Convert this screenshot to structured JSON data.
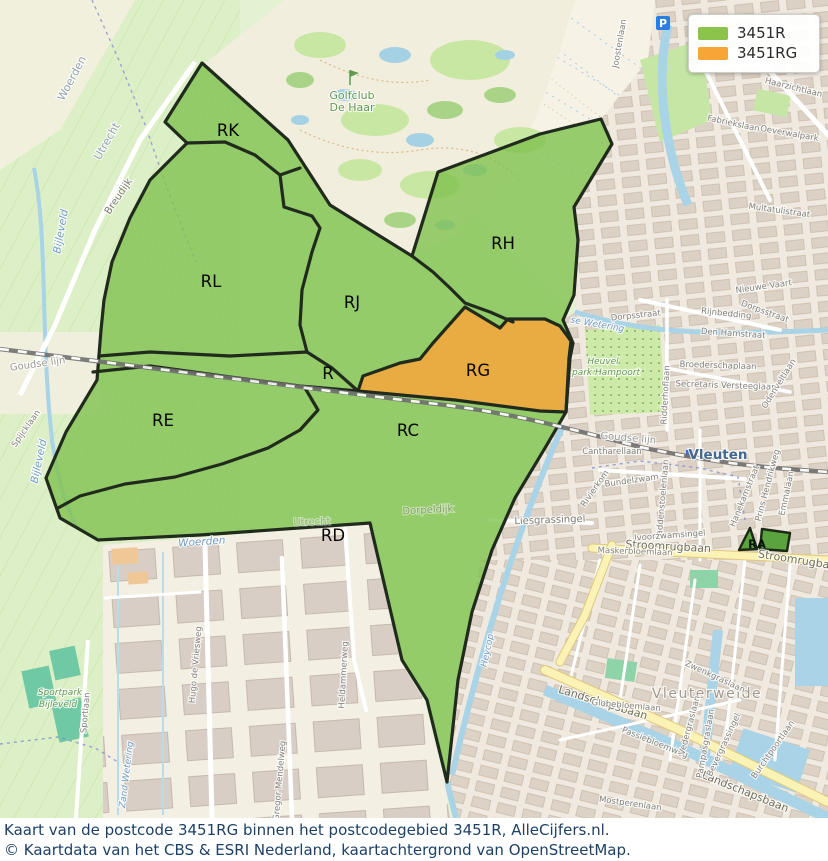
{
  "legend": {
    "items": [
      {
        "label": "3451R",
        "color": "#8bc34b"
      },
      {
        "label": "3451RG",
        "color": "#f6a637"
      }
    ]
  },
  "caption": {
    "line1": "Kaart van de postcode 3451RG binnen het postcodegebied 3451R, AlleCijfers.nl.",
    "line2": "© Kaartdata van het CBS & ESRI Nederland, kaartachtergrond van OpenStreetMap."
  },
  "map": {
    "colors": {
      "region_fill": "#7fc24f",
      "rg_fill": "#efa93f",
      "border": "#212b1d",
      "railway": "#707070",
      "water": "#a9d3e6",
      "urban": "#efe9df",
      "golf": "#f2eedd"
    },
    "region_labels": [
      {
        "label": "RK",
        "x": 228,
        "y": 136
      },
      {
        "label": "RL",
        "x": 211,
        "y": 287
      },
      {
        "label": "RJ",
        "x": 352,
        "y": 308
      },
      {
        "label": "RH",
        "x": 503,
        "y": 249
      },
      {
        "label": "R",
        "x": 328,
        "y": 379
      },
      {
        "label": "RG",
        "x": 478,
        "y": 376
      },
      {
        "label": "RE",
        "x": 163,
        "y": 426
      },
      {
        "label": "RC",
        "x": 408,
        "y": 436
      },
      {
        "label": "RD",
        "x": 333,
        "y": 541
      },
      {
        "label": "RA",
        "x": 757,
        "y": 548,
        "small": true
      }
    ],
    "labels": [
      {
        "text": "Woerden",
        "x": 75,
        "y": 80,
        "rot": -62,
        "cls": "muni"
      },
      {
        "text": "Utrecht",
        "x": 110,
        "y": 143,
        "rot": -60,
        "cls": "muni"
      },
      {
        "text": "Breudijk",
        "x": 121,
        "y": 198,
        "rot": -56,
        "cls": "street"
      },
      {
        "text": "Golfclub",
        "x": 352,
        "y": 99,
        "rot": 0,
        "cls": "green"
      },
      {
        "text": "De Haar",
        "x": 352,
        "y": 111,
        "rot": 0,
        "cls": "green"
      },
      {
        "text": "Bijleveld",
        "x": 64,
        "y": 232,
        "rot": -80,
        "cls": "blue"
      },
      {
        "text": "Goudse lijn",
        "x": 38,
        "y": 367,
        "rot": -8,
        "cls": "gray"
      },
      {
        "text": "Goudse lijn",
        "x": 628,
        "y": 441,
        "rot": 5,
        "cls": "gray"
      },
      {
        "text": "Spijcklaan",
        "x": 28,
        "y": 430,
        "rot": -55,
        "cls": "streetS"
      },
      {
        "text": "Bijleveld",
        "x": 42,
        "y": 462,
        "rot": -78,
        "cls": "blue"
      },
      {
        "text": "Vleuten",
        "x": 718,
        "y": 459,
        "rot": 0,
        "cls": "town"
      },
      {
        "text": "Cantharellaan",
        "x": 612,
        "y": 454,
        "rot": 0,
        "cls": "streetS"
      },
      {
        "text": "Rivierkom",
        "x": 597,
        "y": 490,
        "rot": -55,
        "cls": "streetS"
      },
      {
        "text": "Bundelzwam",
        "x": 632,
        "y": 483,
        "rot": -8,
        "cls": "streetS"
      },
      {
        "text": "Paddenstoelenlaan",
        "x": 665,
        "y": 500,
        "rot": -85,
        "cls": "streetS"
      },
      {
        "text": "Hanekamstraat",
        "x": 747,
        "y": 497,
        "rot": -68,
        "cls": "streetS"
      },
      {
        "text": "Prins Hendrikweg",
        "x": 770,
        "y": 486,
        "rot": -75,
        "cls": "streetS"
      },
      {
        "text": "Emmalaan",
        "x": 789,
        "y": 494,
        "rot": -78,
        "cls": "streetS"
      },
      {
        "text": "Liesgrassingel",
        "x": 550,
        "y": 523,
        "rot": -2,
        "cls": "street"
      },
      {
        "text": "Ivoorzwamsingel",
        "x": 670,
        "y": 538,
        "rot": -4,
        "cls": "streetS"
      },
      {
        "text": "Stroomrugbaan",
        "x": 668,
        "y": 550,
        "rot": 3,
        "cls": "road"
      },
      {
        "text": "Stroomrugbaan",
        "x": 800,
        "y": 564,
        "rot": 9,
        "cls": "road"
      },
      {
        "text": "Maskerbloemlaan",
        "x": 635,
        "y": 554,
        "rot": 2,
        "cls": "streetS"
      },
      {
        "text": "Dorpsstraat",
        "x": 636,
        "y": 318,
        "rot": -6,
        "cls": "streetS"
      },
      {
        "text": "Dorpsstraat",
        "x": 764,
        "y": 314,
        "rot": 20,
        "cls": "streetS"
      },
      {
        "text": "Rijnbedding",
        "x": 726,
        "y": 316,
        "rot": 6,
        "cls": "streetS"
      },
      {
        "text": "Den Hamstraat",
        "x": 733,
        "y": 336,
        "rot": 4,
        "cls": "streetS"
      },
      {
        "text": "Broederschaplaan",
        "x": 718,
        "y": 368,
        "rot": 2,
        "cls": "streetS"
      },
      {
        "text": "Secretaris Versteeglaan",
        "x": 726,
        "y": 388,
        "rot": 2,
        "cls": "streetS"
      },
      {
        "text": "Ridderhoflaan",
        "x": 668,
        "y": 395,
        "rot": -87,
        "cls": "streetS"
      },
      {
        "text": "Odenveltlaan",
        "x": 781,
        "y": 385,
        "rot": -58,
        "cls": "streetS"
      },
      {
        "text": "Nieuwe Vaart",
        "x": 764,
        "y": 289,
        "rot": -8,
        "cls": "streetS"
      },
      {
        "text": "Haarzichtlaan",
        "x": 793,
        "y": 90,
        "rot": 14,
        "cls": "streetS"
      },
      {
        "text": "Oeverwalpark",
        "x": 789,
        "y": 136,
        "rot": 10,
        "cls": "streetS"
      },
      {
        "text": "Multatulistraat",
        "x": 779,
        "y": 213,
        "rot": 8,
        "cls": "streetS"
      },
      {
        "text": "Fabriekslaan",
        "x": 733,
        "y": 126,
        "rot": 12,
        "cls": "streetS"
      },
      {
        "text": "Joostenlaan",
        "x": 622,
        "y": 44,
        "rot": -80,
        "cls": "streetS"
      },
      {
        "text": "Heuvel",
        "x": 603,
        "y": 364,
        "rot": 0,
        "cls": "greenS"
      },
      {
        "text": "park Hampoort",
        "x": 606,
        "y": 375,
        "rot": 0,
        "cls": "greenS"
      },
      {
        "text": "se Wetering",
        "x": 597,
        "y": 327,
        "rot": 10,
        "cls": "blueS"
      },
      {
        "text": "Heycop",
        "x": 490,
        "y": 651,
        "rot": -78,
        "cls": "blueS"
      },
      {
        "text": "Vleuterweide",
        "x": 707,
        "y": 698,
        "rot": 0,
        "cls": "district"
      },
      {
        "text": "Landschapsbaan",
        "x": 602,
        "y": 706,
        "rot": 17,
        "cls": "road"
      },
      {
        "text": "Landschapsbaan",
        "x": 744,
        "y": 795,
        "rot": 22,
        "cls": "road"
      },
      {
        "text": "Globebloemlaan",
        "x": 626,
        "y": 708,
        "rot": 5,
        "cls": "streetS"
      },
      {
        "text": "Passiebloemweg",
        "x": 654,
        "y": 745,
        "rot": 22,
        "cls": "streetS"
      },
      {
        "text": "Mostperenlaan",
        "x": 630,
        "y": 806,
        "rot": 8,
        "cls": "streetS"
      },
      {
        "text": "Vedergraslaan",
        "x": 692,
        "y": 726,
        "rot": -75,
        "cls": "streetS"
      },
      {
        "text": "Zwenkgraslaan",
        "x": 714,
        "y": 679,
        "rot": 25,
        "cls": "streetS"
      },
      {
        "text": "Pampasgraslaan",
        "x": 708,
        "y": 744,
        "rot": -80,
        "cls": "streetS"
      },
      {
        "text": "Bevergrassingel",
        "x": 726,
        "y": 746,
        "rot": -65,
        "cls": "streetS"
      },
      {
        "text": "Burchtpoortlaan",
        "x": 775,
        "y": 751,
        "rot": -55,
        "cls": "streetS"
      },
      {
        "text": "Dorpeldijk",
        "x": 428,
        "y": 513,
        "rot": -3,
        "cls": "street",
        "dim": true
      },
      {
        "text": "Utrecht",
        "x": 312,
        "y": 525,
        "rot": -2,
        "cls": "gray",
        "dim": true
      },
      {
        "text": "Woerden",
        "x": 202,
        "y": 545,
        "rot": -4,
        "cls": "blue"
      },
      {
        "text": "Hugo de Vriesweg",
        "x": 198,
        "y": 665,
        "rot": -85,
        "cls": "streetS"
      },
      {
        "text": "Gregor Mendelweg",
        "x": 282,
        "y": 781,
        "rot": -85,
        "cls": "streetS"
      },
      {
        "text": "Heldammerweg",
        "x": 346,
        "y": 675,
        "rot": -87,
        "cls": "streetS"
      },
      {
        "text": "Zand Wetering",
        "x": 129,
        "y": 775,
        "rot": -83,
        "cls": "blueS"
      },
      {
        "text": "Sportpark",
        "x": 60,
        "y": 695,
        "rot": 0,
        "cls": "greenS"
      },
      {
        "text": "Bijleveld",
        "x": 58,
        "y": 707,
        "rot": 0,
        "cls": "greenS"
      },
      {
        "text": "Sportlaan",
        "x": 88,
        "y": 713,
        "rot": -85,
        "cls": "streetS"
      }
    ]
  }
}
